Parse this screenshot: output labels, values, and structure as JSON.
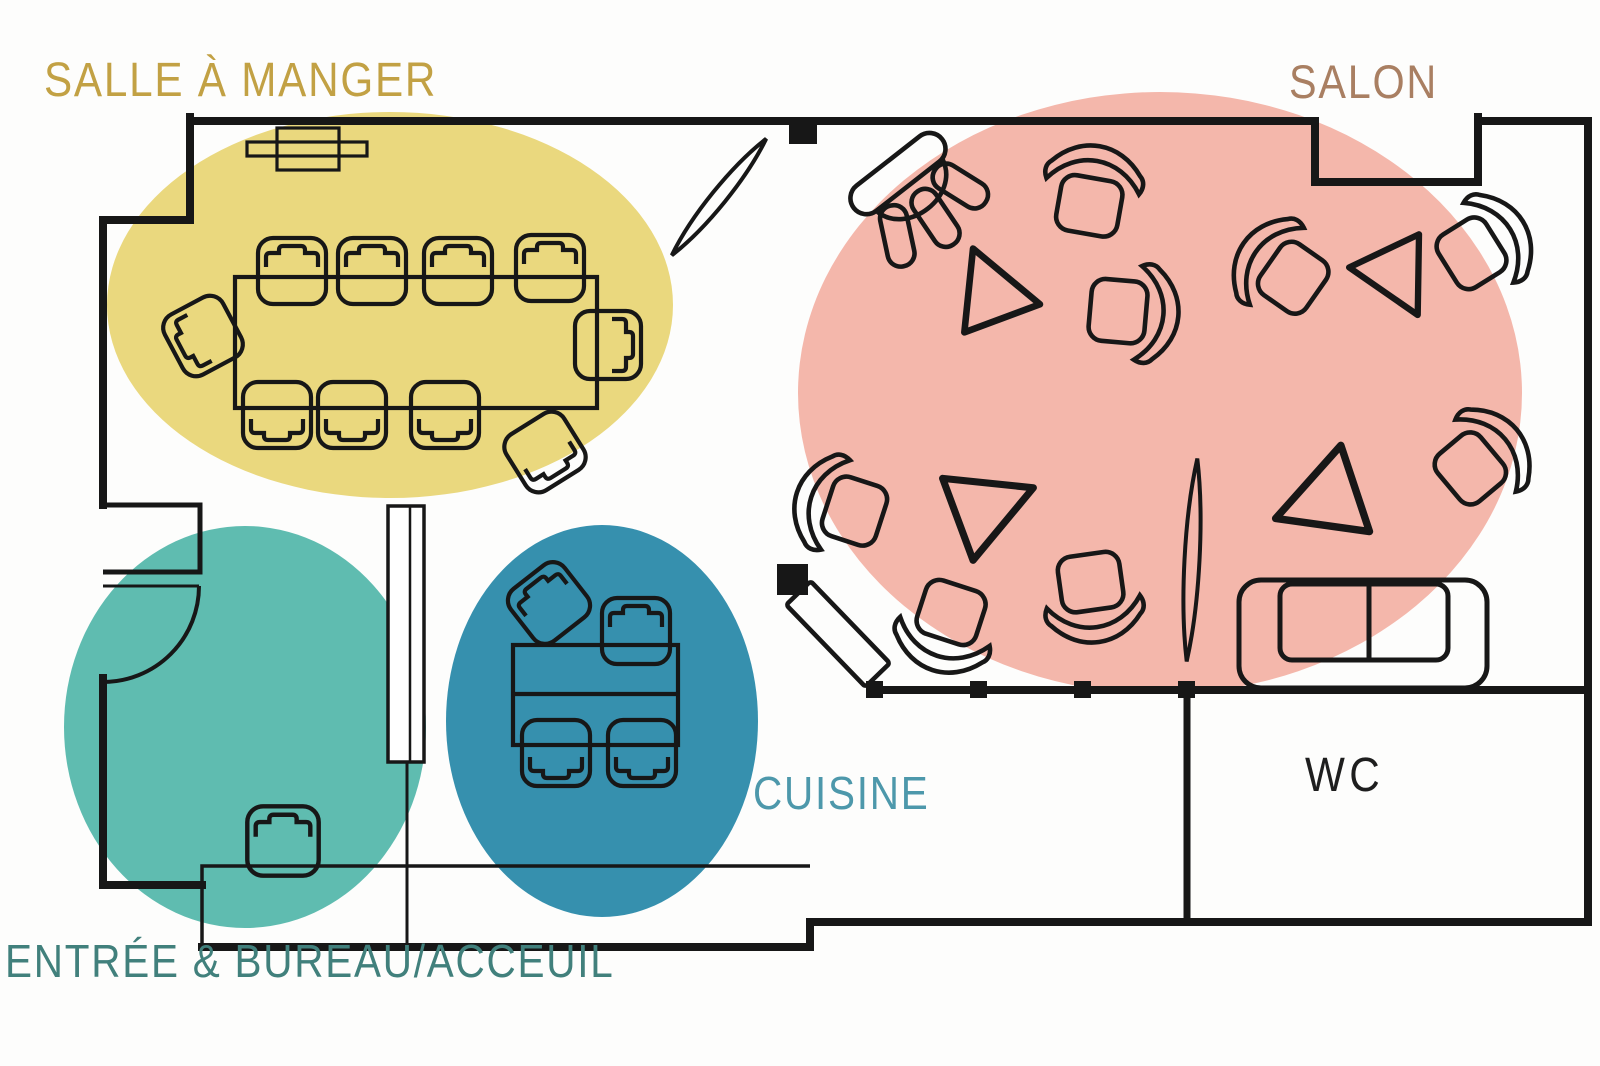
{
  "rooms": {
    "dining": {
      "label": "SALLE À MANGER"
    },
    "salon": {
      "label": "SALON"
    },
    "kitchen": {
      "label": "CUISINE"
    },
    "entry": {
      "label": "ENTRÉE & BUREAU/ACCEUIL"
    },
    "wc": {
      "label": "WC"
    }
  },
  "colors": {
    "dining_zone": "#EAD87E",
    "salon_zone": "#F4B7AB",
    "entry_zone": "#5FBCB0",
    "kitchen_zone": "#3690AE",
    "dining_label": "#C2A144",
    "salon_label": "#A97F62",
    "kitchen_label": "#4D98AB",
    "entry_label": "#41807C",
    "wc_label": "#1E1E1E",
    "wall": "#171717",
    "background": "#FDFDFC"
  },
  "furniture_counts": {
    "dining": {
      "table": 1,
      "chairs": 9,
      "radiator": 1
    },
    "salon": {
      "lounge_chairs": 8,
      "stool": 1,
      "triangle_tables": 4,
      "plants": 2,
      "sofa": 1
    },
    "kitchen": {
      "table": 1,
      "chairs": 4
    },
    "entry": {
      "counter": 1,
      "chair": 1,
      "partition": 1,
      "door": 1
    },
    "wc": {}
  },
  "icons": {
    "chair": "chair-icon",
    "lounge_chair": "lounge-chair-icon",
    "stool": "stool-icon",
    "triangle_table": "triangle-table-icon",
    "plant": "plant-leaf-icon",
    "sofa": "sofa-icon",
    "door_swing": "door-swing-icon",
    "door_leaf": "door-leaf-icon",
    "radiator": "radiator-icon",
    "wall_marker": "wall-marker-icon"
  }
}
